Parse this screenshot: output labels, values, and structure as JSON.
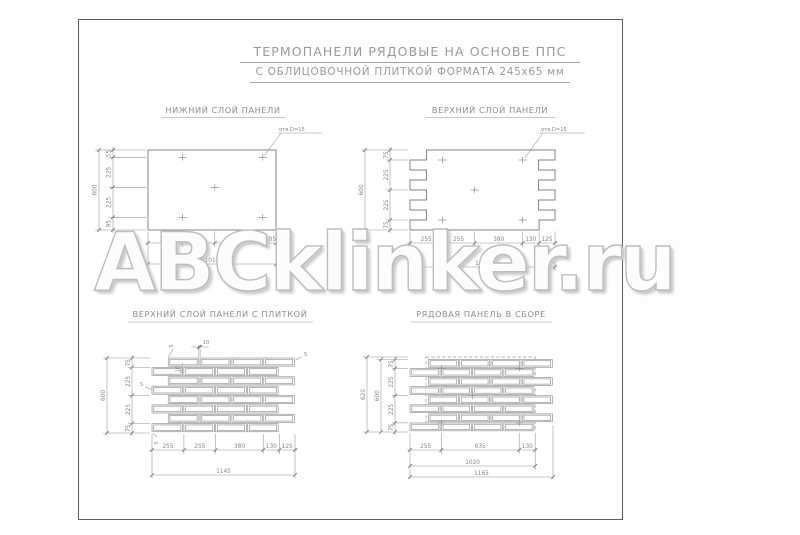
{
  "page": {
    "watermark_text": "ABCklinker.ru"
  },
  "header": {
    "title_line1": "ТЕРМОПАНЕЛИ РЯДОВЫЕ НА ОСНОВЕ ППС",
    "title_line2": "С ОБЛИЦОВОЧНОЙ ПЛИТКОЙ ФОРМАТА 245х65 мм"
  },
  "drawings": {
    "bottom_layer": {
      "title": "НИЖНИЙ СЛОЙ ПАНЕЛИ",
      "hole_callout": "отв.D=15",
      "dims_left": [
        "55",
        "225",
        "225",
        "95"
      ],
      "dim_left_total": "600",
      "dims_bottom": [
        "275",
        "255",
        "380",
        "105"
      ],
      "dim_bottom_total": "1015"
    },
    "top_layer": {
      "title": "ВЕРХНИЙ СЛОЙ ПАНЕЛИ",
      "hole_callout": "отв.D=15",
      "dims_left": [
        "75",
        "225",
        "225",
        "75"
      ],
      "dim_left_total": "600",
      "dims_bottom": [
        "255",
        "255",
        "380",
        "130",
        "125"
      ],
      "dim_bottom_total": "1145"
    },
    "top_layer_tiled": {
      "title": "ВЕРХНИЙ СЛОЙ ПАНЕЛИ С ПЛИТКОЙ",
      "dims_left": [
        "75",
        "225",
        "225",
        "75"
      ],
      "dim_left_total": "600",
      "dims_bottom": [
        "255",
        "255",
        "380",
        "130",
        "125"
      ],
      "dim_bottom_total": "1145",
      "joint_dims": [
        "10",
        "10"
      ],
      "gap_dims": [
        "5",
        "5",
        "5",
        "5"
      ]
    },
    "assembled": {
      "title": "РЯДОВАЯ ПАНЕЛЬ В СБОРЕ",
      "dims_left": [
        "75",
        "225",
        "225",
        "75"
      ],
      "dim_left_total_inner": "600",
      "dim_left_total_outer": "620",
      "dims_bottom": [
        "255",
        "635",
        "130"
      ],
      "dim_bottom_total_inner": "1020",
      "dim_bottom_total_outer": "1165"
    }
  }
}
